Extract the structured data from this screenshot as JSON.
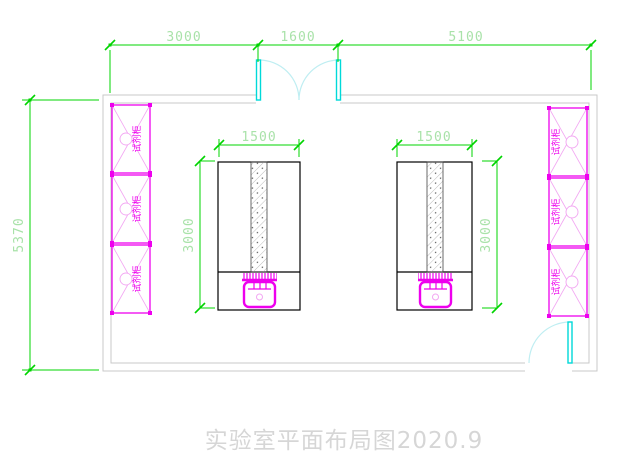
{
  "drawing_title": "实验室平面布局图2020.9",
  "dimensions": {
    "top_segments": [
      {
        "label": "3000"
      },
      {
        "label": "1600"
      },
      {
        "label": "5100"
      }
    ],
    "room_height": "5370",
    "bench_left": {
      "width": "1500",
      "depth": "3000"
    },
    "bench_right": {
      "width": "1500",
      "depth": "3000"
    }
  },
  "labels": {
    "cabinet": "试剂柜"
  },
  "colors": {
    "dimension_line": "#00d400",
    "dimension_text": "#a9e2a9",
    "wall": "#c9c9c9",
    "cabinet_magenta": "#ee00ee",
    "cabinet_light_magenta": "#f2a6f2",
    "door_cyan": "#00d9d9",
    "door_arc_cyan": "#bfeef2",
    "bench_outline": "#000000",
    "title_gray": "#d6d6d6",
    "background": "#ffffff"
  }
}
